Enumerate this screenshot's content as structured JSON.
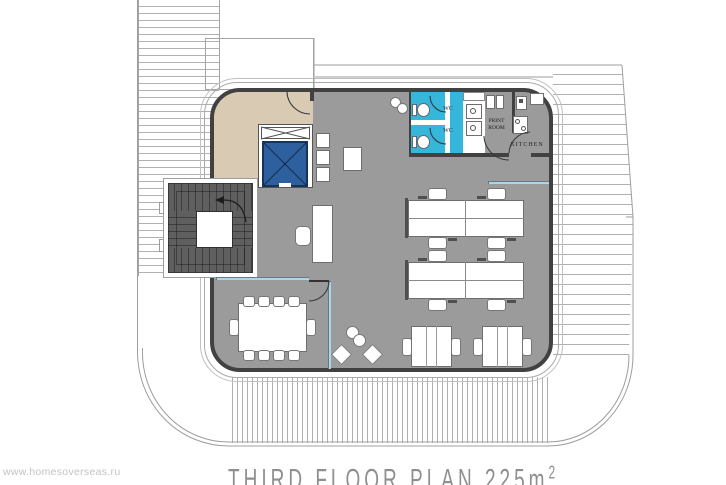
{
  "document": {
    "kind": "architectural floor plan"
  },
  "title": {
    "main": "THIRD FLOOR PLAN 225m",
    "superscript": "2"
  },
  "watermark": "www.homesoverseas.ru",
  "labels": {
    "wc_upper": "WC",
    "wc_lower": "WC",
    "print_line1": "PRINT",
    "print_line2": "ROOM",
    "kitchen": "KITCHEN"
  },
  "colors": {
    "building_floor": "#9b9b9b",
    "wall": "#414141",
    "entrance_hall": "#d9cbb3",
    "elevator_cab": "#2e5f9e",
    "wc_floor": "#35b7dc",
    "glass_partition": "#aed6e6",
    "stairs_dark": "#5f5f5f",
    "hatch_line": "#b0b0b0",
    "outline": "#9e9e9e",
    "title_text": "#8f8f8f",
    "watermark_text": "#c2c2c2"
  }
}
